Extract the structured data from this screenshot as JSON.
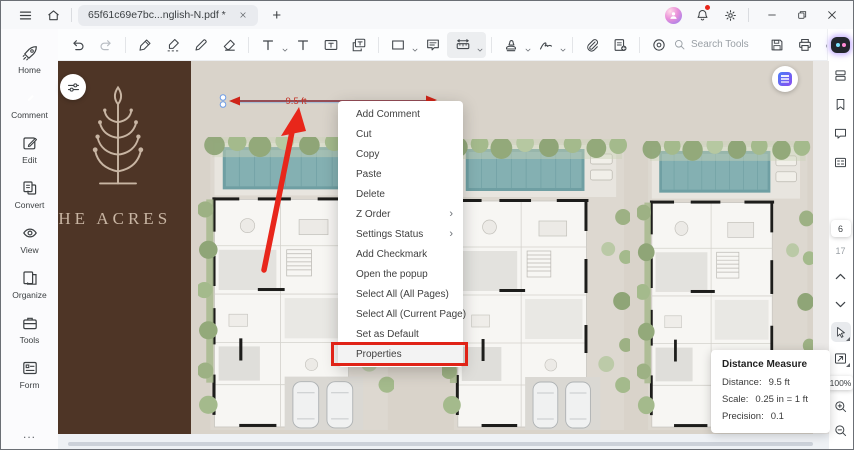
{
  "titlebar": {
    "tab_title": "65f61c69e7bc...nglish-N.pdf *",
    "new_tab_label": "+"
  },
  "toolbar": {
    "search_label": "Search Tools"
  },
  "sidebar_left": {
    "items": [
      {
        "label": "Home"
      },
      {
        "label": "Comment",
        "active": true
      },
      {
        "label": "Edit"
      },
      {
        "label": "Convert"
      },
      {
        "label": "View"
      },
      {
        "label": "Organize"
      },
      {
        "label": "Tools"
      },
      {
        "label": "Form"
      }
    ],
    "more_label": "..."
  },
  "sidebar_right": {
    "current_page": "6",
    "total_pages": "17",
    "zoom_level": "100%"
  },
  "document": {
    "brand_text": "THE ACRES",
    "measurement_label": "9.5 ft"
  },
  "context_menu": {
    "items": [
      {
        "label": "Add Comment"
      },
      {
        "label": "Cut"
      },
      {
        "label": "Copy"
      },
      {
        "label": "Paste"
      },
      {
        "label": "Delete"
      },
      {
        "label": "Z Order",
        "submenu": true
      },
      {
        "label": "Settings Status",
        "submenu": true
      },
      {
        "label": "Add Checkmark"
      },
      {
        "label": "Open the popup"
      },
      {
        "label": "Select All (All Pages)"
      },
      {
        "label": "Select All (Current Page)"
      },
      {
        "label": "Set as Default"
      },
      {
        "label": "Properties",
        "highlighted": true
      }
    ]
  },
  "measure_panel": {
    "title": "Distance Measure",
    "rows": [
      {
        "label": "Distance:",
        "value": "9.5 ft"
      },
      {
        "label": "Scale:",
        "value": "0.25 in = 1 ft"
      },
      {
        "label": "Precision:",
        "value": "0.1"
      }
    ]
  },
  "colors": {
    "annotation_red": "#e8261b",
    "measure_line": "#7e2130",
    "highlight_box_red": "#e02317",
    "comment_active_green": "#2fb578",
    "brand_panel_brown": "#4e3526",
    "page_beige": "#d9d3ca",
    "pool_teal": "#6f9fa3"
  }
}
